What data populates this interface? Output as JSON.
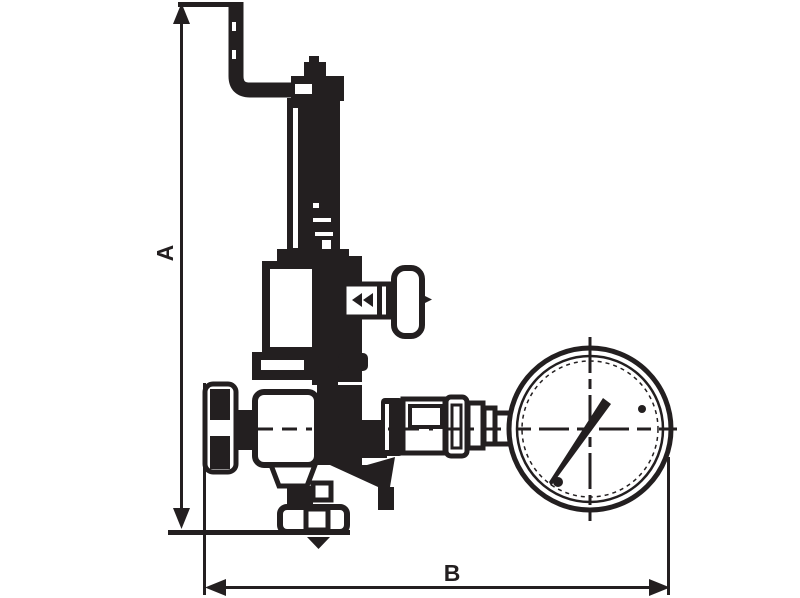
{
  "drawing": {
    "kind": "technical-dimension-drawing",
    "subject": "pressure-reducing-valve-with-gauge",
    "ink_color": "#231f20",
    "background_color": "#ffffff"
  },
  "dimensions": {
    "a": {
      "label": "A",
      "orientation": "vertical",
      "position": "left"
    },
    "b": {
      "label": "B",
      "orientation": "horizontal",
      "position": "bottom"
    }
  },
  "components": {
    "handle": "bent-rod-handle",
    "stem": "threaded-adjusting-stem",
    "bonnet": "spring-bonnet",
    "side_handle": "side-t-handle",
    "body": "valve-body",
    "inlet": "inlet-port",
    "outlet_foot": "bottom-outlet-flange",
    "flow_arrow": "downward-flow-arrow",
    "union_stack": "gauge-union-fittings",
    "gauge": "pressure-gauge-dial",
    "needle": "gauge-needle"
  }
}
